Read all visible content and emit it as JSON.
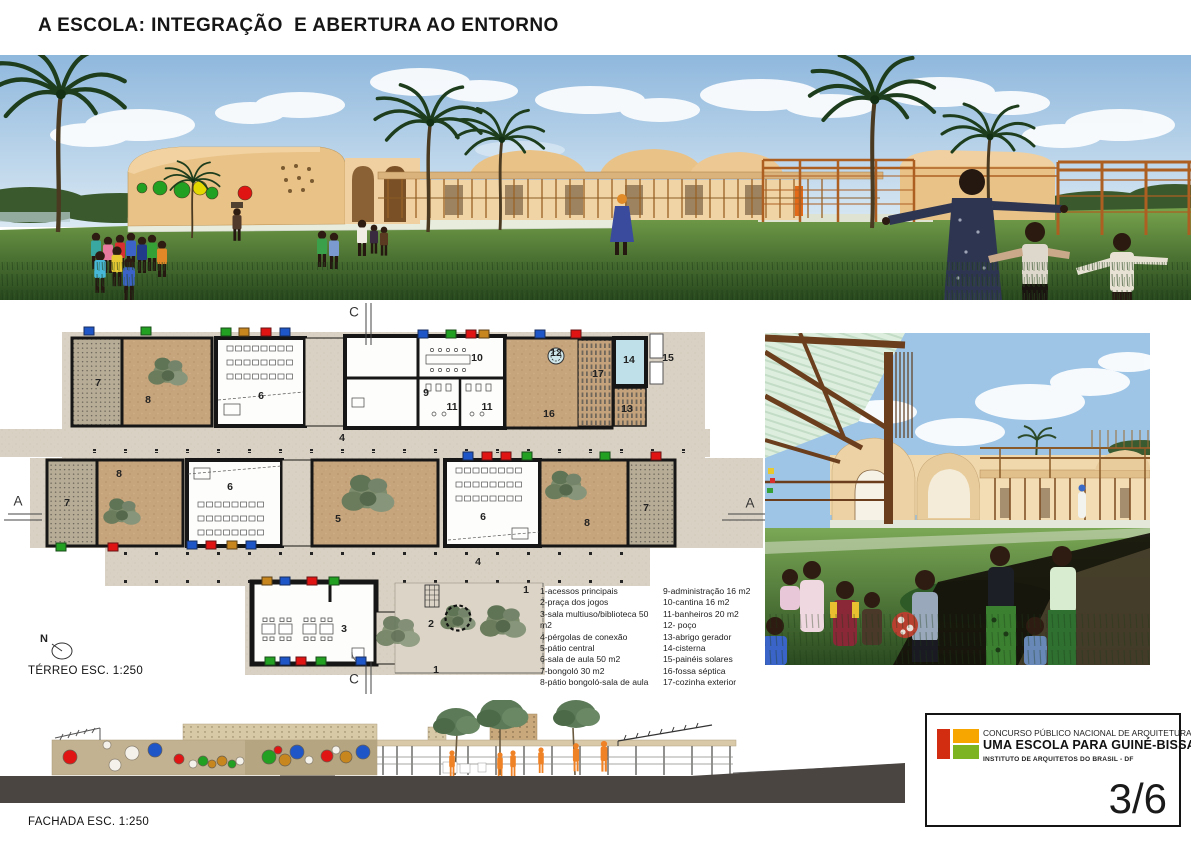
{
  "page": {
    "title": "A ESCOLA: INTEGRAÇÃO  E ABERTURA AO ENTORNO"
  },
  "palette": {
    "b": "#1e56c8",
    "g": "#21a021",
    "r": "#e11414",
    "o": "#c8861e",
    "y": "#e3d800",
    "w": "#f4f1ea"
  },
  "plan": {
    "scale_label": "TÉRREO ESC. 1:250",
    "north_label": "N",
    "labels": [
      {
        "t": "7",
        "x": 98,
        "y": 383
      },
      {
        "t": "8",
        "x": 148,
        "y": 400
      },
      {
        "t": "6",
        "x": 261,
        "y": 396
      },
      {
        "t": "9",
        "x": 426,
        "y": 393
      },
      {
        "t": "10",
        "x": 477,
        "y": 358
      },
      {
        "t": "11",
        "x": 452,
        "y": 407
      },
      {
        "t": "11",
        "x": 487,
        "y": 407
      },
      {
        "t": "12",
        "x": 556,
        "y": 353
      },
      {
        "t": "16",
        "x": 549,
        "y": 414
      },
      {
        "t": "17",
        "x": 598,
        "y": 374
      },
      {
        "t": "13",
        "x": 627,
        "y": 409
      },
      {
        "t": "14",
        "x": 629,
        "y": 360
      },
      {
        "t": "15",
        "x": 668,
        "y": 358
      },
      {
        "t": "4",
        "x": 342,
        "y": 438
      },
      {
        "t": "7",
        "x": 67,
        "y": 503
      },
      {
        "t": "8",
        "x": 119,
        "y": 474
      },
      {
        "t": "6",
        "x": 230,
        "y": 487
      },
      {
        "t": "5",
        "x": 338,
        "y": 519
      },
      {
        "t": "6",
        "x": 483,
        "y": 517
      },
      {
        "t": "8",
        "x": 587,
        "y": 523
      },
      {
        "t": "7",
        "x": 646,
        "y": 508
      },
      {
        "t": "4",
        "x": 478,
        "y": 562
      },
      {
        "t": "3",
        "x": 344,
        "y": 629
      },
      {
        "t": "2",
        "x": 431,
        "y": 624
      },
      {
        "t": "1",
        "x": 526,
        "y": 590
      },
      {
        "t": "1",
        "x": 436,
        "y": 670
      },
      {
        "t": "C",
        "x": 354,
        "y": 312,
        "s": "sec"
      },
      {
        "t": "C",
        "x": 354,
        "y": 679,
        "s": "sec"
      },
      {
        "t": "A",
        "x": 18,
        "y": 501,
        "s": "sec"
      },
      {
        "t": "A",
        "x": 750,
        "y": 503,
        "s": "sec"
      }
    ],
    "markers": [
      {
        "x": 89,
        "y": 331,
        "c": "b"
      },
      {
        "x": 146,
        "y": 331,
        "c": "g"
      },
      {
        "x": 226,
        "y": 332,
        "c": "g"
      },
      {
        "x": 244,
        "y": 332,
        "c": "o"
      },
      {
        "x": 266,
        "y": 332,
        "c": "r"
      },
      {
        "x": 285,
        "y": 332,
        "c": "b"
      },
      {
        "x": 423,
        "y": 334,
        "c": "b"
      },
      {
        "x": 451,
        "y": 334,
        "c": "g"
      },
      {
        "x": 471,
        "y": 334,
        "c": "r"
      },
      {
        "x": 484,
        "y": 334,
        "c": "o"
      },
      {
        "x": 540,
        "y": 334,
        "c": "b"
      },
      {
        "x": 576,
        "y": 334,
        "c": "r"
      },
      {
        "x": 468,
        "y": 456,
        "c": "b"
      },
      {
        "x": 487,
        "y": 456,
        "c": "r"
      },
      {
        "x": 506,
        "y": 456,
        "c": "r"
      },
      {
        "x": 527,
        "y": 456,
        "c": "g"
      },
      {
        "x": 605,
        "y": 456,
        "c": "g"
      },
      {
        "x": 656,
        "y": 456,
        "c": "r"
      },
      {
        "x": 61,
        "y": 547,
        "c": "g"
      },
      {
        "x": 113,
        "y": 547,
        "c": "r"
      },
      {
        "x": 192,
        "y": 545,
        "c": "b"
      },
      {
        "x": 211,
        "y": 545,
        "c": "r"
      },
      {
        "x": 232,
        "y": 545,
        "c": "o"
      },
      {
        "x": 251,
        "y": 545,
        "c": "b"
      },
      {
        "x": 267,
        "y": 581,
        "c": "o"
      },
      {
        "x": 285,
        "y": 581,
        "c": "b"
      },
      {
        "x": 312,
        "y": 581,
        "c": "r"
      },
      {
        "x": 334,
        "y": 581,
        "c": "g"
      },
      {
        "x": 270,
        "y": 661,
        "c": "g"
      },
      {
        "x": 285,
        "y": 661,
        "c": "b"
      },
      {
        "x": 301,
        "y": 661,
        "c": "r"
      },
      {
        "x": 321,
        "y": 661,
        "c": "g"
      },
      {
        "x": 361,
        "y": 661,
        "c": "b"
      }
    ]
  },
  "legend": {
    "col1": [
      "1-acessos principais",
      "2-praça dos jogos",
      "3-sala multiuso/biblioteca 50 m2",
      "4-pérgolas de conexão",
      "5-pátio central",
      "6-sala de aula 50 m2",
      "7-bongoló 30 m2",
      "8-pátio bongoló-sala de aula"
    ],
    "col2": [
      "9-administração 16 m2",
      "10-cantina 16 m2",
      "11-banheiros 20 m2",
      "12- poço",
      "13-abrigo gerador",
      "14-cisterna",
      "15-painéis solares",
      "16-fossa séptica",
      "17-cozinha exterior"
    ]
  },
  "facade": {
    "scale_label": "FACHADA ESC. 1:250",
    "circles": [
      {
        "x": 70,
        "y": 757,
        "r": 7,
        "c": "r"
      },
      {
        "x": 107,
        "y": 745,
        "r": 4,
        "c": "w"
      },
      {
        "x": 115,
        "y": 765,
        "r": 6,
        "c": "w"
      },
      {
        "x": 132,
        "y": 753,
        "r": 7,
        "c": "w"
      },
      {
        "x": 155,
        "y": 750,
        "r": 7,
        "c": "b"
      },
      {
        "x": 179,
        "y": 759,
        "r": 5,
        "c": "r"
      },
      {
        "x": 193,
        "y": 764,
        "r": 4,
        "c": "w"
      },
      {
        "x": 203,
        "y": 761,
        "r": 5,
        "c": "g"
      },
      {
        "x": 212,
        "y": 764,
        "r": 4,
        "c": "o"
      },
      {
        "x": 222,
        "y": 761,
        "r": 5,
        "c": "o"
      },
      {
        "x": 232,
        "y": 764,
        "r": 4,
        "c": "g"
      },
      {
        "x": 240,
        "y": 761,
        "r": 4,
        "c": "w"
      },
      {
        "x": 269,
        "y": 757,
        "r": 7,
        "c": "g"
      },
      {
        "x": 278,
        "y": 750,
        "r": 4,
        "c": "r"
      },
      {
        "x": 285,
        "y": 760,
        "r": 6,
        "c": "o"
      },
      {
        "x": 297,
        "y": 752,
        "r": 7,
        "c": "b"
      },
      {
        "x": 309,
        "y": 760,
        "r": 4,
        "c": "w"
      },
      {
        "x": 327,
        "y": 756,
        "r": 6,
        "c": "r"
      },
      {
        "x": 336,
        "y": 750,
        "r": 4,
        "c": "w"
      },
      {
        "x": 346,
        "y": 757,
        "r": 6,
        "c": "o"
      },
      {
        "x": 363,
        "y": 752,
        "r": 7,
        "c": "b"
      }
    ]
  },
  "panorama": {
    "windows": [
      {
        "x": 142,
        "y": 188,
        "r": 5,
        "c": "g"
      },
      {
        "x": 160,
        "y": 188,
        "r": 7,
        "c": "g"
      },
      {
        "x": 182,
        "y": 190,
        "r": 8,
        "c": "g"
      },
      {
        "x": 200,
        "y": 188,
        "r": 7,
        "c": "y"
      },
      {
        "x": 212,
        "y": 193,
        "r": 6,
        "c": "g"
      },
      {
        "x": 245,
        "y": 193,
        "r": 7,
        "c": "r"
      }
    ]
  },
  "titleblock": {
    "line1": "CONCURSO PÚBLICO NACIONAL DE ARQUITETURA",
    "line2": "UMA ESCOLA PARA GUINÉ-BISSAU",
    "line3": "INSTITUTO DE ARQUITETOS DO BRASIL - DF",
    "sheet": "3/6",
    "logo_red": "#d22d10",
    "logo_orange": "#f7a600",
    "logo_green": "#7db422"
  }
}
